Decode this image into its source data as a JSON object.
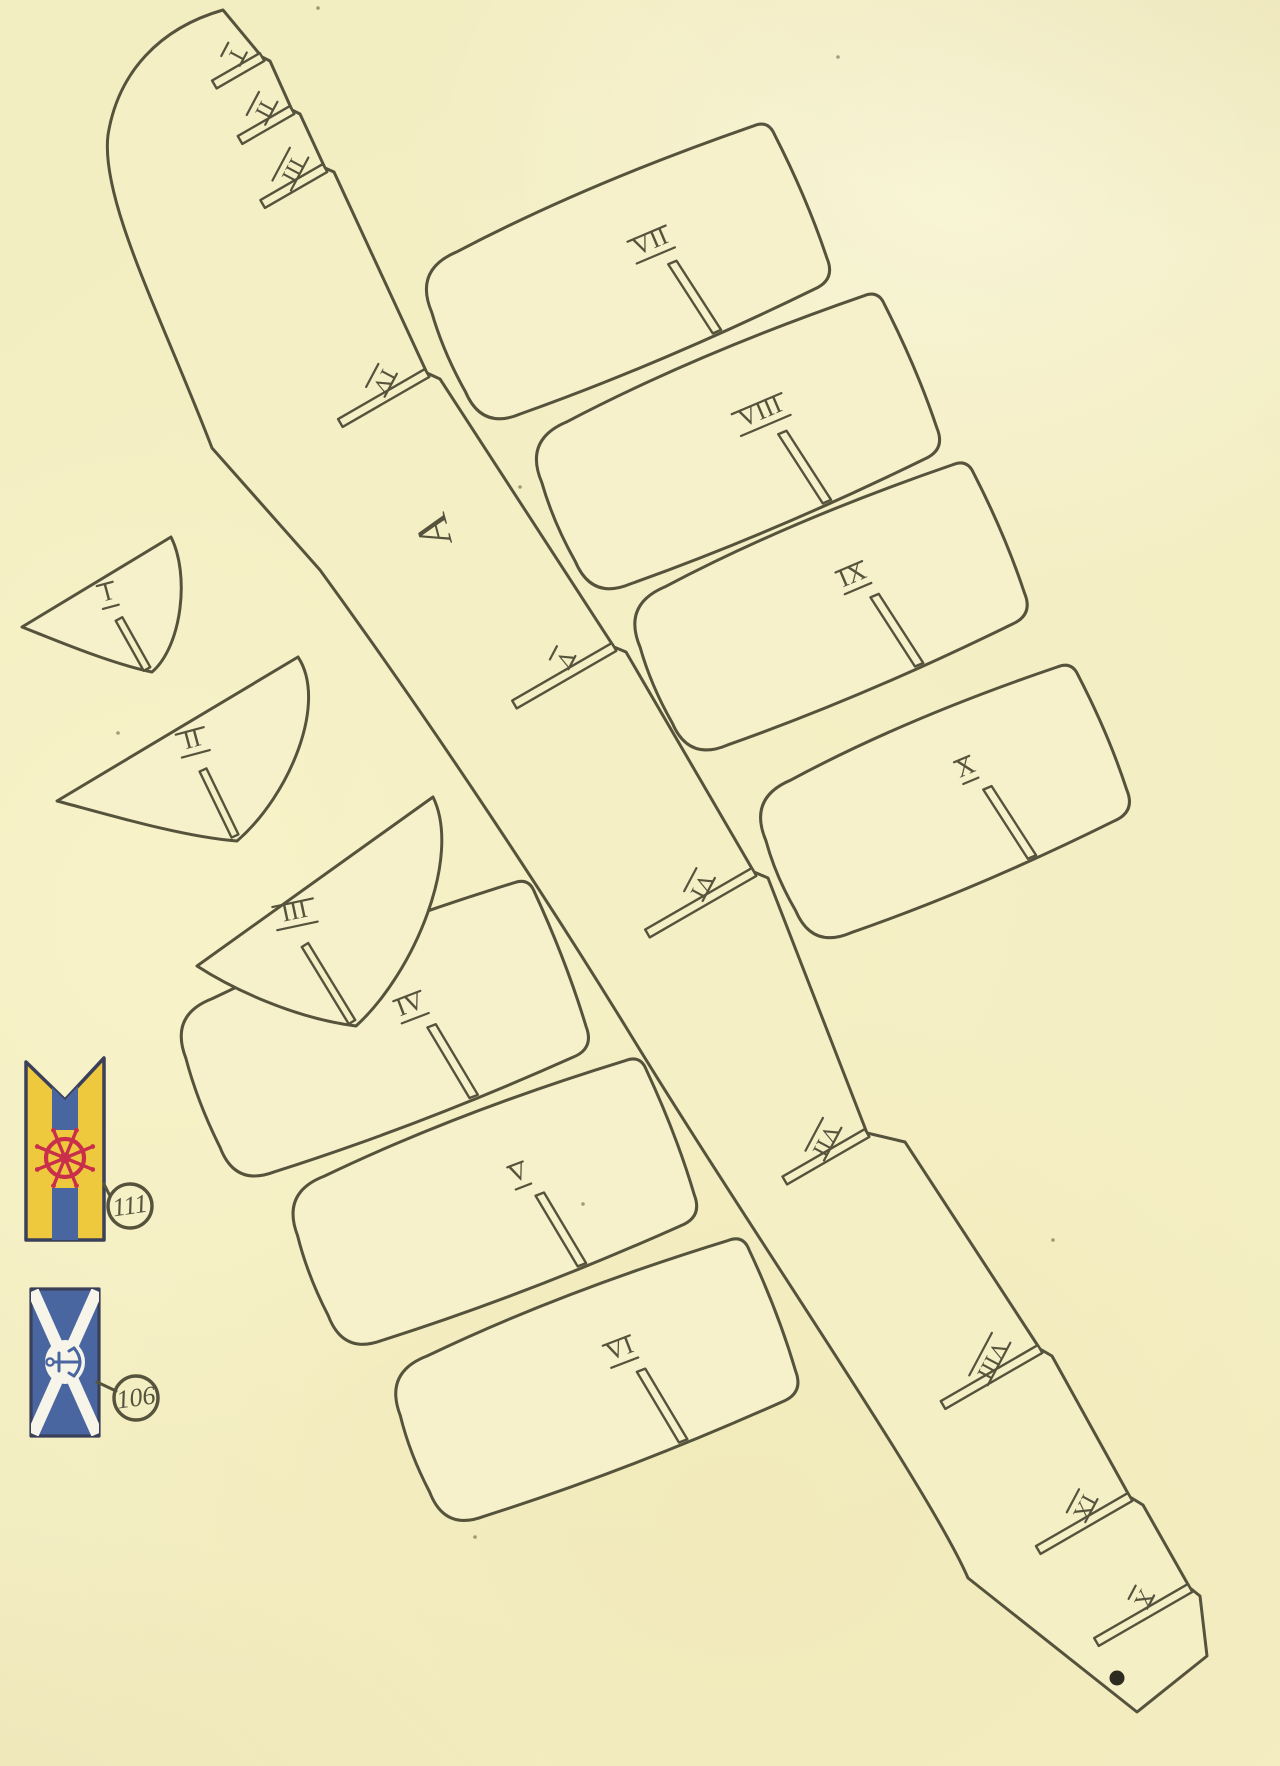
{
  "palette": {
    "ink": "#56533d",
    "paper": "#f5efc6",
    "piece_fill": "#f6f1ca",
    "navy": "#3a4059",
    "flag_blue": "#4a66a0",
    "flag_yellow": "#eec93e",
    "flag_red": "#c92f4a",
    "white": "#f7f5e9",
    "dot": "#2e2c21"
  },
  "keel": {
    "part_label": "A",
    "label_pos": [
      448,
      527
    ],
    "label_rot": -105,
    "slot_angle_deg": 150,
    "label_rot_slots": 118,
    "slots": [
      {
        "label": "I",
        "entry": [
          262,
          57
        ],
        "len": 55
      },
      {
        "label": "II",
        "entry": [
          292,
          110
        ],
        "len": 60
      },
      {
        "label": "III",
        "entry": [
          325,
          168
        ],
        "len": 72
      },
      {
        "label": "IV",
        "entry": [
          427,
          373
        ],
        "len": 100
      },
      {
        "label": "V",
        "entry": [
          614,
          647
        ],
        "len": 115
      },
      {
        "label": "VI",
        "entry": [
          754,
          872
        ],
        "len": 123
      },
      {
        "label": "VII",
        "entry": [
          867,
          1133
        ],
        "len": 95
      },
      {
        "label": "VIII",
        "entry": [
          1040,
          1349
        ],
        "len": 112
      },
      {
        "label": "IX",
        "entry": [
          1130,
          1497
        ],
        "len": 106
      },
      {
        "label": "X",
        "entry": [
          1190,
          1588
        ],
        "len": 108
      }
    ],
    "tip_dot": [
      1117,
      1678
    ]
  },
  "deck_pieces": [
    {
      "label": "VII",
      "center": [
        625,
        275
      ],
      "w": 385,
      "h": 174,
      "rot": -23
    },
    {
      "label": "VIII",
      "center": [
        735,
        445
      ],
      "w": 385,
      "h": 174,
      "rot": -23
    },
    {
      "label": "IX",
      "center": [
        828,
        610
      ],
      "w": 375,
      "h": 170,
      "rot": -23
    },
    {
      "label": "X",
      "center": [
        942,
        805
      ],
      "w": 352,
      "h": 164,
      "rot": -23
    },
    {
      "label": "IV",
      "center": [
        382,
        1032
      ],
      "w": 385,
      "h": 184,
      "rot": -21
    },
    {
      "label": "V",
      "center": [
        492,
        1205
      ],
      "w": 385,
      "h": 174,
      "rot": -21
    },
    {
      "label": "VI",
      "center": [
        594,
        1383
      ],
      "w": 385,
      "h": 170,
      "rot": -21
    }
  ],
  "bow_pieces": [
    {
      "label": "I",
      "label_pos": [
        109,
        600
      ],
      "label_rot": -15,
      "slot": [
        [
          147,
          669
        ],
        [
          119,
          619
        ]
      ]
    },
    {
      "label": "II",
      "label_pos": [
        194,
        747
      ],
      "label_rot": -15,
      "slot": [
        [
          235,
          836
        ],
        [
          203,
          770
        ]
      ]
    },
    {
      "label": "III",
      "label_pos": [
        296,
        919
      ],
      "label_rot": -12,
      "slot": [
        [
          352,
          1022
        ],
        [
          305,
          945
        ]
      ]
    }
  ],
  "flags": {
    "pennant": {
      "callout": "111",
      "outline": [
        [
          26,
          1062
        ],
        [
          65,
          1100
        ],
        [
          104,
          1058
        ],
        [
          104,
          1240
        ],
        [
          26,
          1240
        ]
      ],
      "stripe_top_poly": [
        [
          52,
          1087
        ],
        [
          65,
          1100
        ],
        [
          78,
          1086
        ],
        [
          78,
          1130
        ],
        [
          52,
          1130
        ]
      ],
      "stripe_bottom_rect": [
        52,
        1188,
        26,
        52
      ],
      "wheel_center": [
        65,
        1158
      ],
      "callout_center": [
        130,
        1206
      ],
      "connector": [
        [
          104,
          1184
        ],
        [
          110,
          1196
        ]
      ]
    },
    "saltire": {
      "callout": "106",
      "rect": [
        31,
        1289,
        68,
        147
      ],
      "emblem_center": [
        65,
        1362
      ],
      "callout_center": [
        136,
        1398
      ],
      "connector": [
        [
          97,
          1382
        ],
        [
          116,
          1391
        ]
      ]
    }
  },
  "specks": [
    [
      318,
      8
    ],
    [
      838,
      57
    ],
    [
      520,
      487
    ],
    [
      118,
      733
    ],
    [
      583,
      1204
    ],
    [
      475,
      1537
    ],
    [
      1053,
      1240
    ]
  ]
}
